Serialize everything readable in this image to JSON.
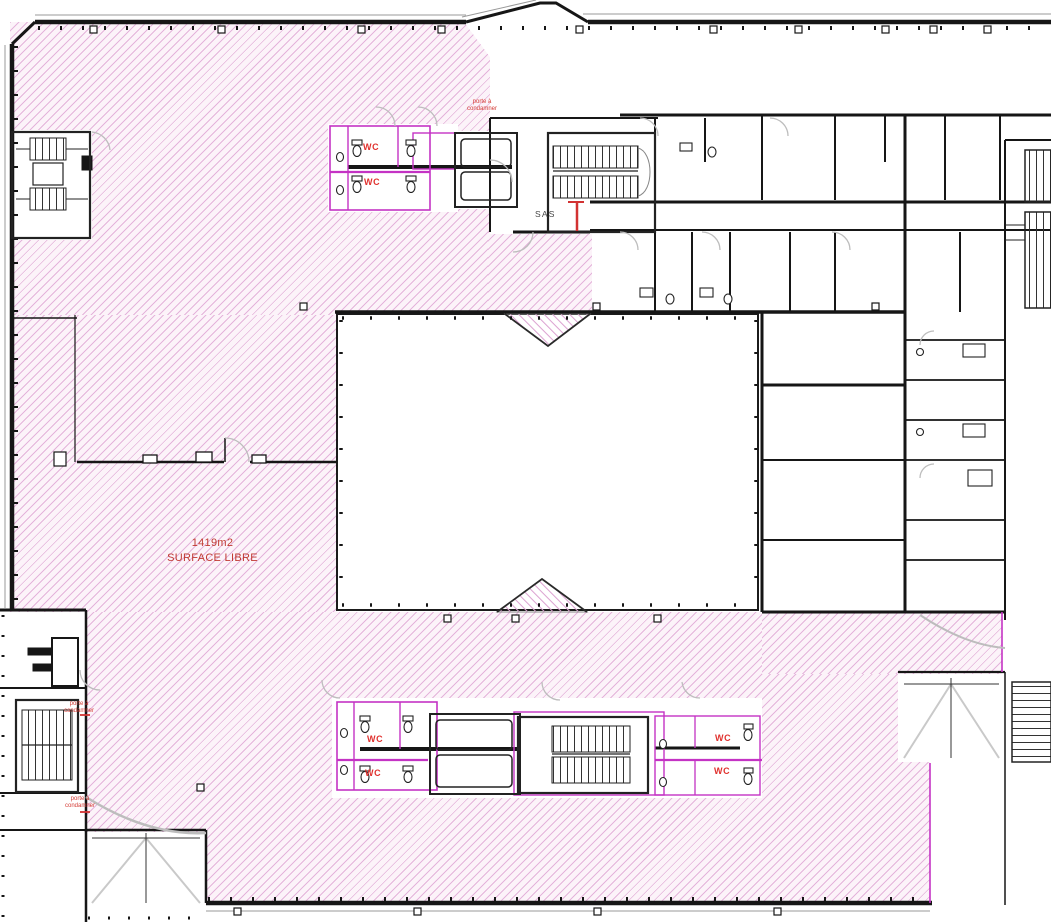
{
  "plan": {
    "free_zone": {
      "area_label": "1419m2",
      "name_label": "SURFACE LIBRE"
    },
    "room_labels": {
      "sas": "SAS",
      "wc": "WC"
    },
    "door_note": {
      "line1": "porte à",
      "line2": "condamner"
    },
    "colors": {
      "free_surface_hatch": "#d180c2",
      "partition_magenta": "#c433c4",
      "annotation_red": "#d23232",
      "wall": "#161616",
      "door_swing": "#bdbdbd"
    }
  }
}
